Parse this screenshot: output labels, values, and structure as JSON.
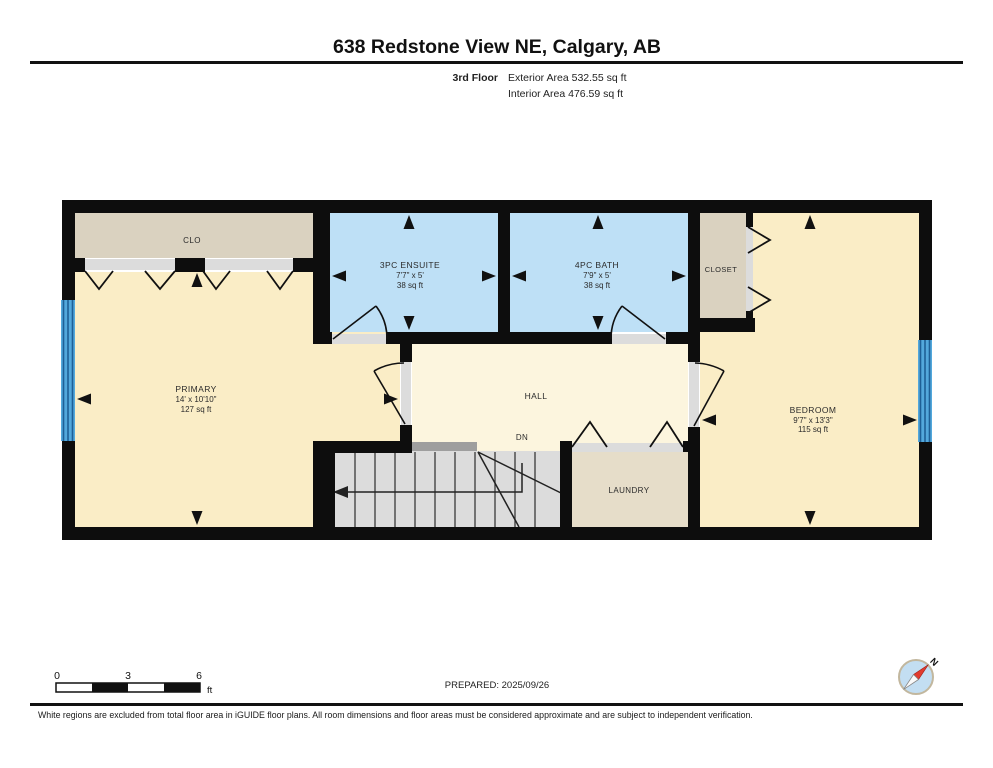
{
  "header": {
    "title": "638 Redstone View NE, Calgary, AB",
    "floor_label": "3rd Floor",
    "exterior_area": "Exterior Area 532.55 sq ft",
    "interior_area": "Interior Area 476.59 sq ft"
  },
  "rooms": {
    "clo": {
      "name": "CLO"
    },
    "ensuite": {
      "name": "3PC ENSUITE",
      "dimensions": "7'7\" x 5'",
      "area": "38 sq ft"
    },
    "bath": {
      "name": "4PC BATH",
      "dimensions": "7'9\" x 5'",
      "area": "38 sq ft"
    },
    "closet": {
      "name": "CLOSET"
    },
    "primary": {
      "name": "PRIMARY",
      "dimensions": "14' x 10'10\"",
      "area": "127 sq ft"
    },
    "hall": {
      "name": "HALL"
    },
    "stairs": {
      "direction_label": "DN"
    },
    "laundry": {
      "name": "LAUNDRY"
    },
    "bedroom": {
      "name": "BEDROOM",
      "dimensions": "9'7\" x 13'3\"",
      "area": "115 sq ft"
    }
  },
  "scale_bar": {
    "tick_0": "0",
    "tick_3": "3",
    "tick_6": "6",
    "unit": "ft"
  },
  "prepared_label": "PREPARED: 2025/09/26",
  "compass": {
    "north_label": "N"
  },
  "footer_disclaimer": "White regions are excluded from total floor area in iGUIDE floor plans. All room dimensions and floor areas must be considered approximate and are subject to independent verification.",
  "colors": {
    "wall": "#0d0d0d",
    "room_cream": "#FAEDC6",
    "hall_cream": "#FCF5DE",
    "closet_tan": "#DAD2C0",
    "laundry_tan": "#E6DDC9",
    "bath_blue": "#BEE0F6",
    "stair_gray": "#DCDCDC",
    "door_track": "#DCDCDC",
    "threshold_gray": "#9E9E9E",
    "window_blue": "#53A8DC",
    "window_stripe": "#1E5F96",
    "compass_red": "#E23B2E"
  }
}
